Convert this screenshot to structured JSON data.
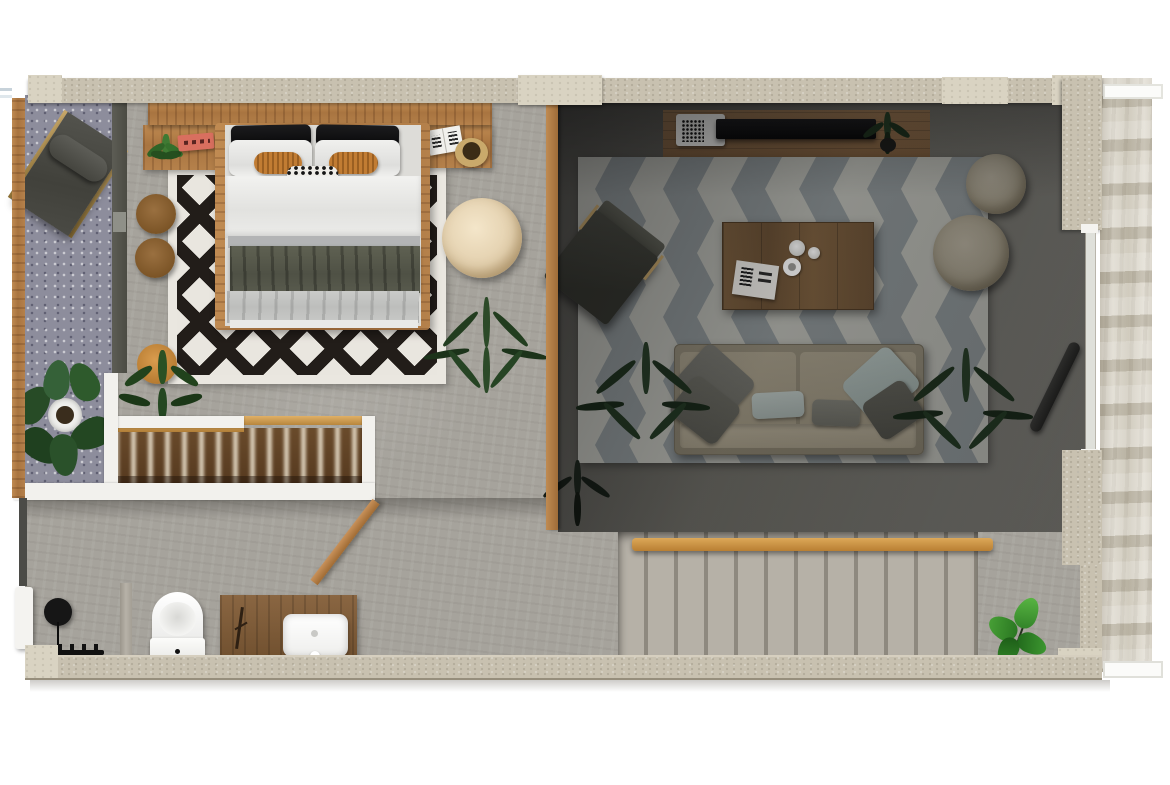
{
  "meta": {
    "kind": "apartment-floor-plan-3d-top-view",
    "visible_text": "none"
  },
  "palette": {
    "wall": "#c8c1b0",
    "wall-light": "#d9d3c2",
    "wood": "#b9834f",
    "wood-dark": "#8a6029",
    "floor": "#a6a39c",
    "balcony": "#8d8d9c",
    "living": "#6b6a64",
    "rug-white": "#e9e6df",
    "rug-black": "#221d19",
    "chev-light": "#b4b5ae",
    "chev-gray": "#899092",
    "pouf": "#e7d7bb",
    "orange": "#b5702a",
    "coral": "#d96f5f",
    "blanket": "#585a4d",
    "white": "#f2f1ed",
    "stairs": "#aca79d",
    "exterior": "#cfc9bb",
    "partition": "#54544c",
    "plant": "#2c4d28",
    "plant-bright": "#47a035",
    "sofa": "#968e7b",
    "pillow-blue": "#a5b2ae",
    "pillow-gray": "#62625b",
    "black": "#141414",
    "glass": "#dfe0da"
  },
  "scene": {
    "labels": {
      "plan": "apartment floor plan, top view 3D render",
      "balcony": "side terrace with lounge chair and plant",
      "bedroom": "bedroom with double bed on black and white diamond rug",
      "closet": "open wardrobe with hanging clothes",
      "bathroom": "bathroom with toilet and wooden vanity",
      "living": "living room with sofa, coffee table and chevron rug",
      "stairs": "concrete staircase with wooden handrail"
    },
    "furniture": [
      "lounge-chair",
      "double-bed",
      "headboard-shelf",
      "bedside-tables",
      "round-side-tables",
      "rattan-pouf",
      "palm-plant",
      "wardrobe",
      "toilet",
      "vanity-sink",
      "floor-lamp",
      "bench",
      "tv-console",
      "tv",
      "laptop",
      "coffee-table",
      "sofa",
      "throw-pillows",
      "floor-poufs",
      "armchair",
      "staircase",
      "handrail",
      "potted-plants"
    ]
  }
}
